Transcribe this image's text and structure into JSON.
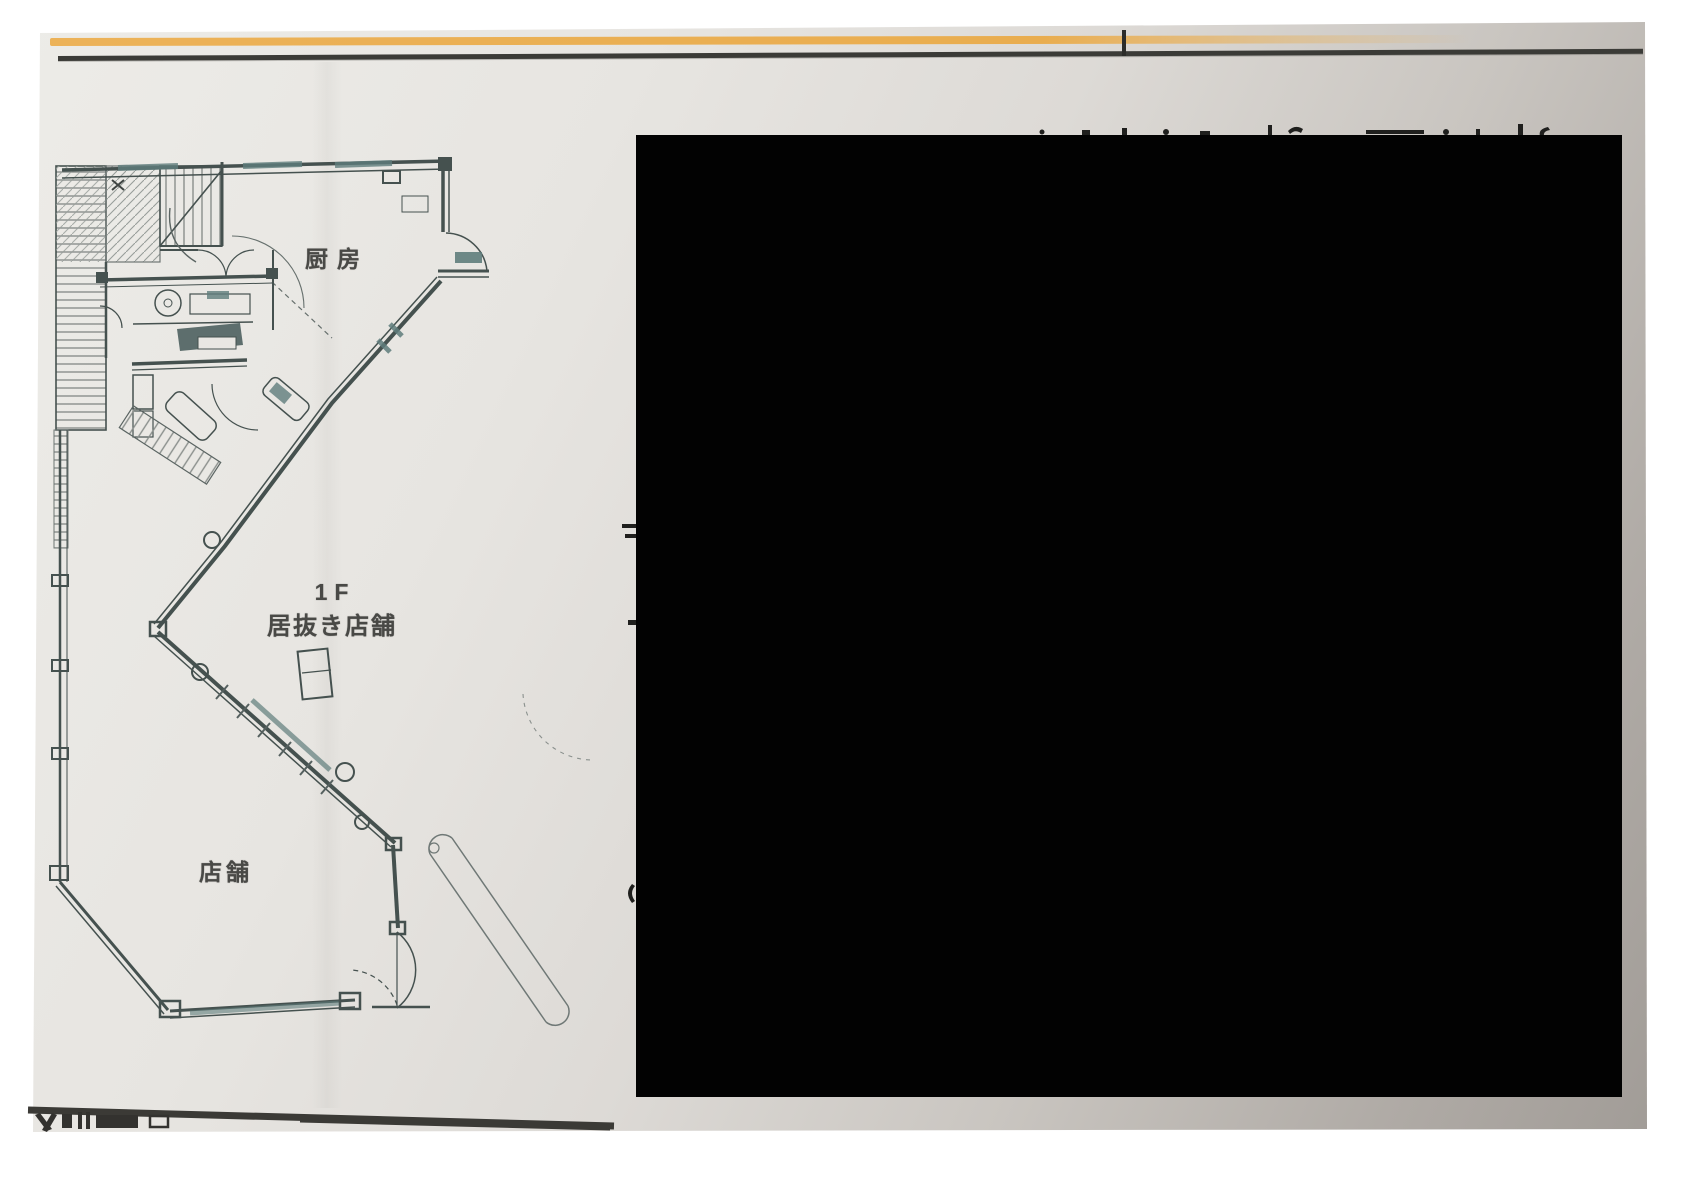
{
  "page": {
    "background": "#ffffff"
  },
  "photo": {
    "paper_color_light": "#edece8",
    "paper_color_dark": "#9e9994",
    "accent_strip_color": "#e9ad4f",
    "rule_color": "#3b3b37"
  },
  "floor_plan": {
    "ink_color": "#45514f",
    "teal_color": "#5f7d7c",
    "labels": {
      "kitchen": "厨房",
      "floor_level": "1F",
      "leasehold_store": "居抜き店舗",
      "store": "店舗"
    }
  },
  "redaction": {
    "color": "#020202"
  }
}
